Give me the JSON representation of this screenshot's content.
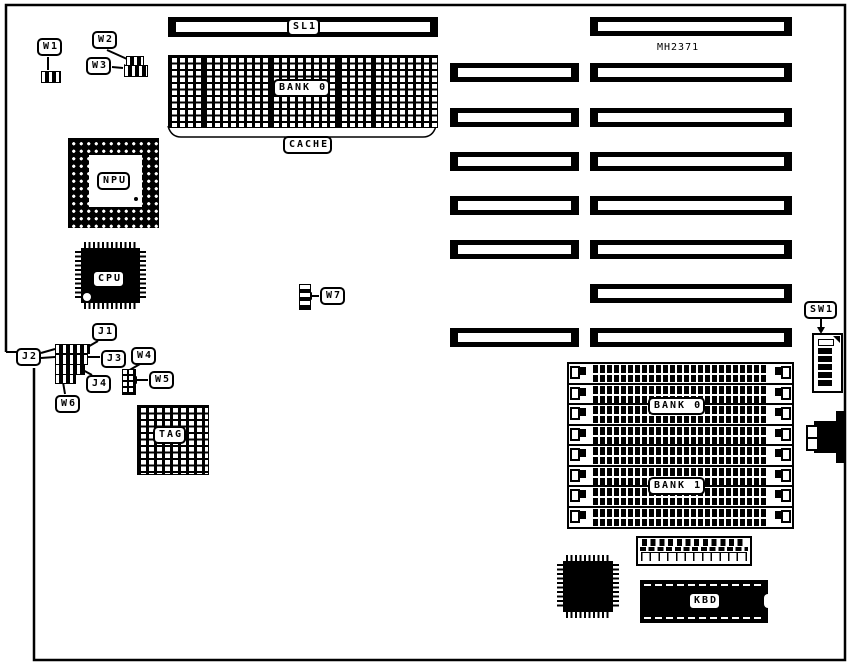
{
  "board": {
    "model": "MH2371"
  },
  "labels": {
    "w1": "W1",
    "w2": "W2",
    "w3": "W3",
    "w4": "W4",
    "w5": "W5",
    "w6": "W6",
    "w7": "W7",
    "j1": "J1",
    "j2": "J2",
    "j3": "J3",
    "j4": "J4",
    "sl1": "SL1",
    "cache_bank": "BANK 0",
    "cache": "CACHE",
    "npu": "NPU",
    "cpu": "CPU",
    "tag": "TAG",
    "sw1": "SW1",
    "simm_bank0": "BANK 0",
    "simm_bank1": "BANK 1",
    "kbd": "KBD"
  },
  "memory": {
    "simm_socket_count": 8,
    "banks": [
      "BANK 0",
      "BANK 1"
    ]
  },
  "expansion": {
    "long_slot_count": 8,
    "short_slot_count": 6,
    "cpu_local_slot": "SL1"
  },
  "cache_chips": {
    "count": 5,
    "bank": "BANK 0",
    "group": "CACHE"
  }
}
